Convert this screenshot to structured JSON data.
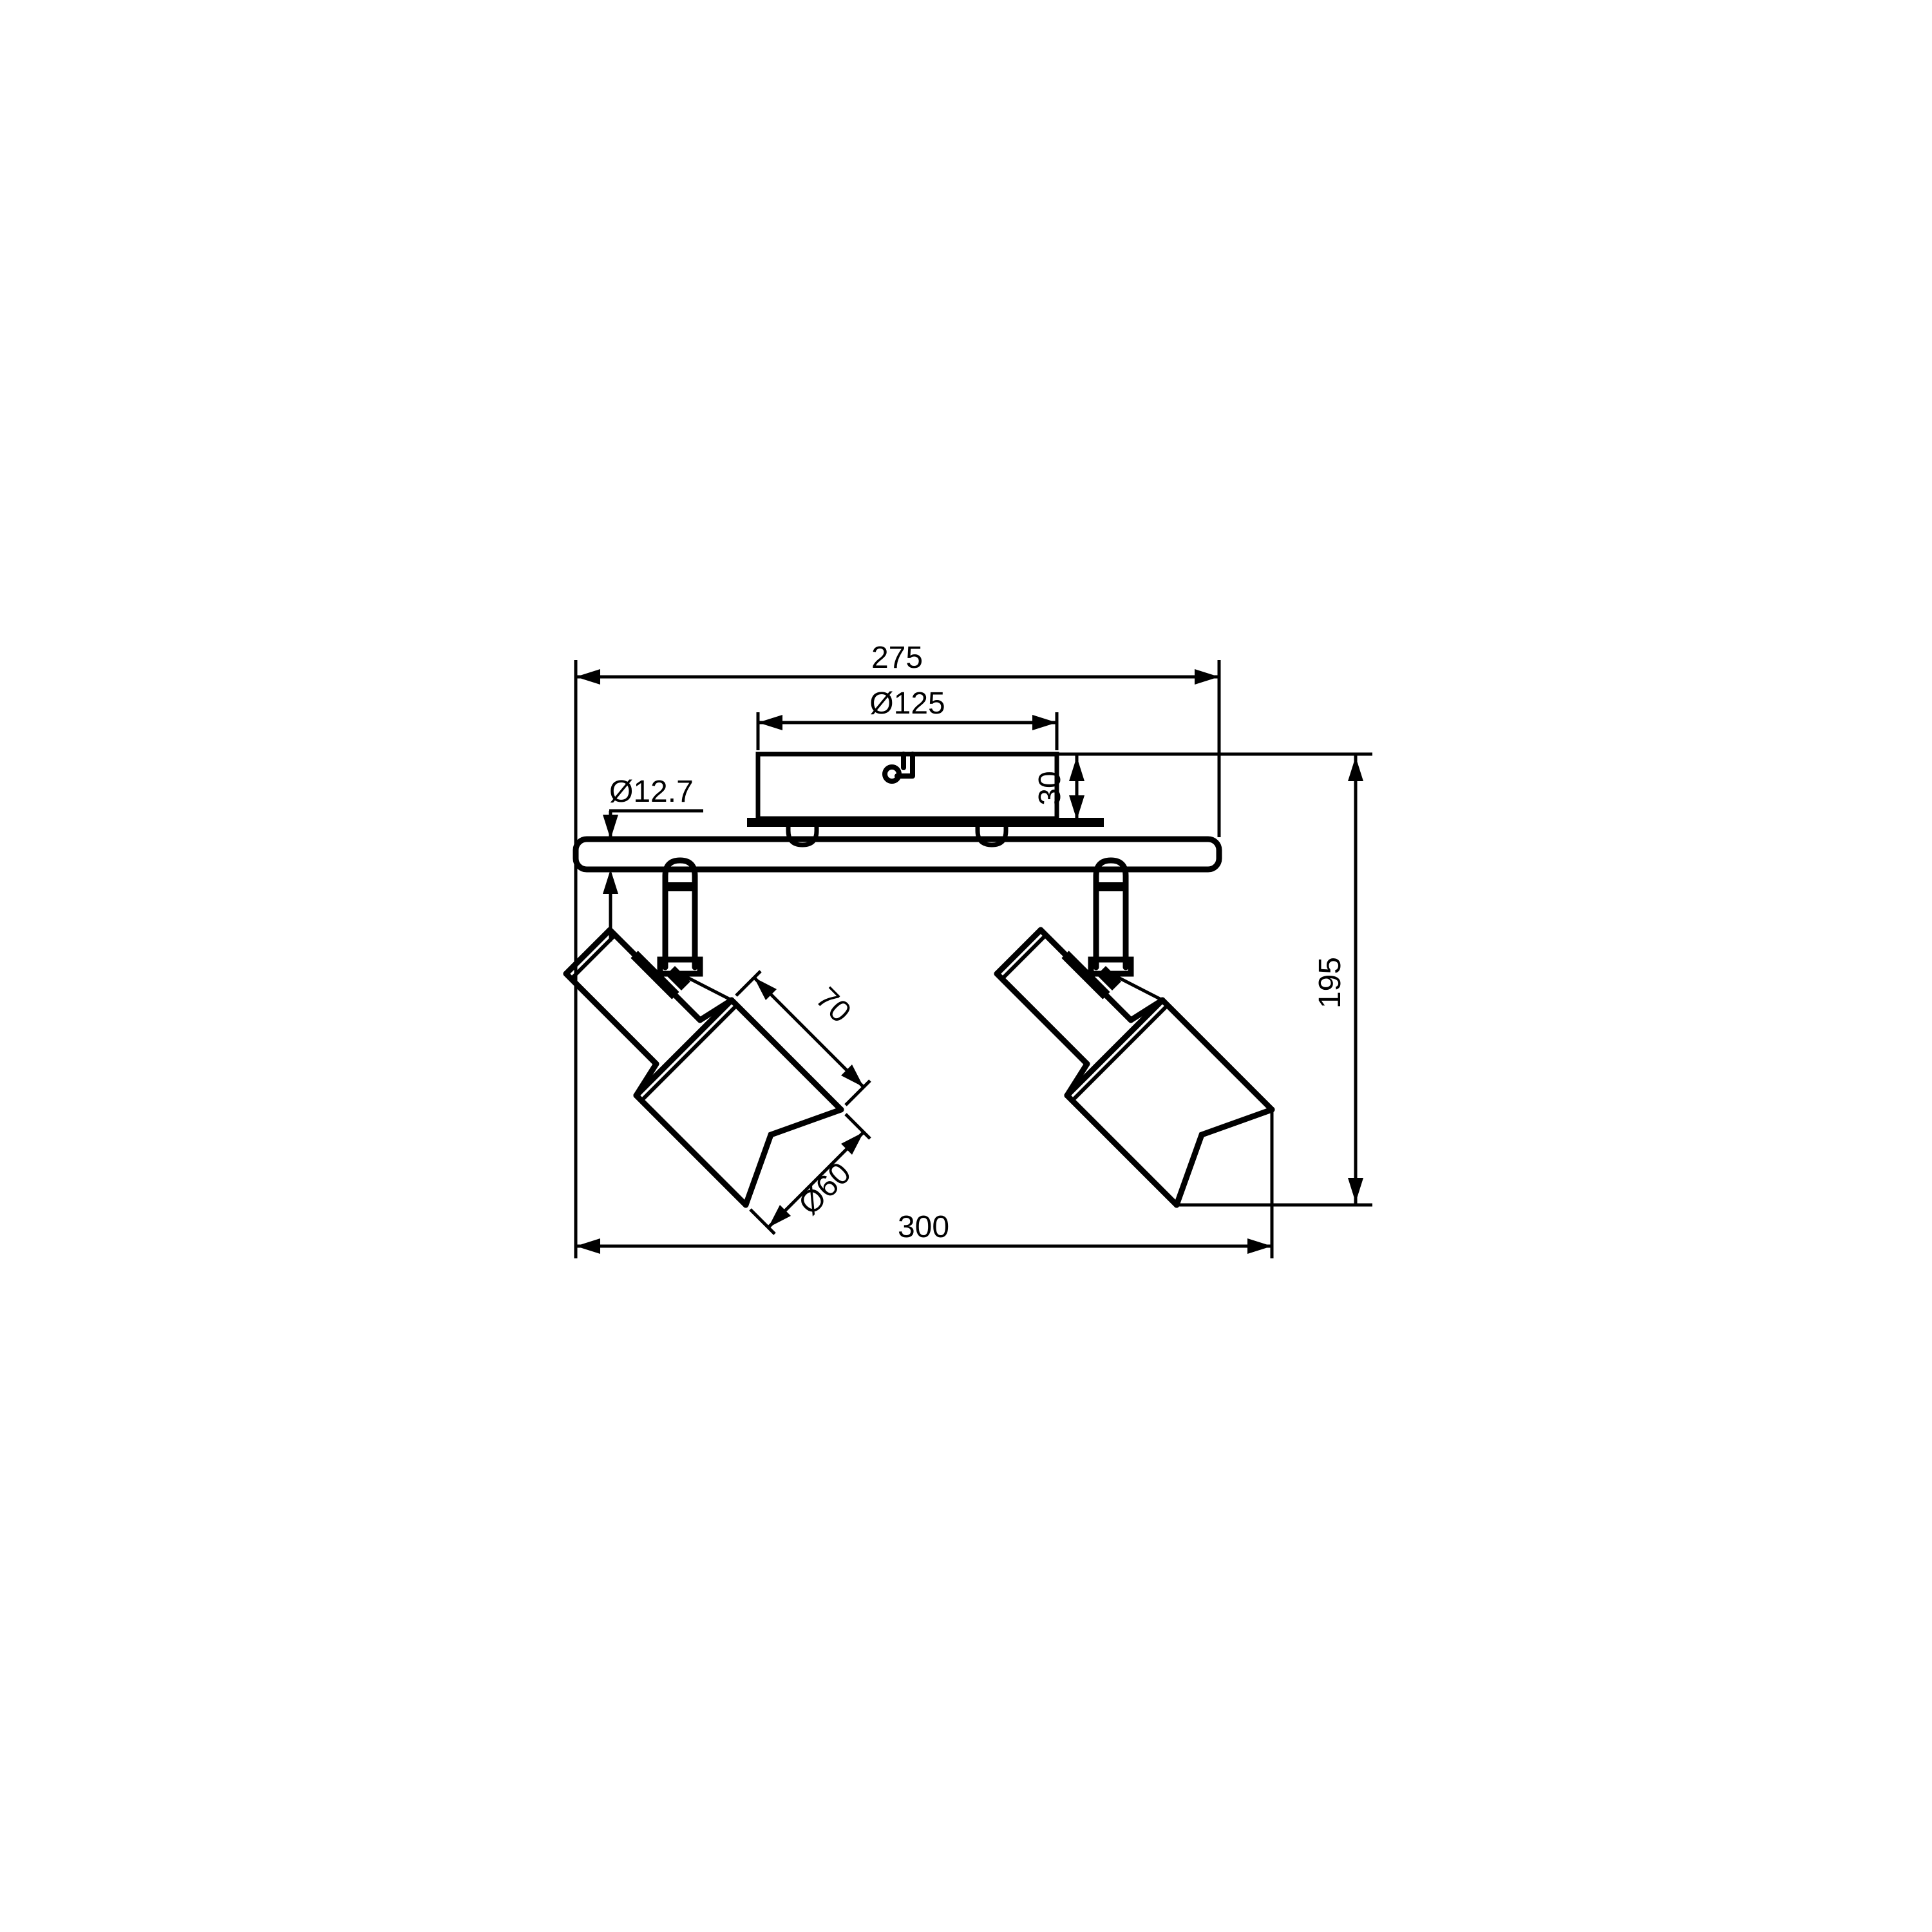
{
  "drawing": {
    "colors": {
      "background": "#ffffff",
      "line": "#000000"
    },
    "icons": {
      "canopy_icon": "cable-grommet-icon"
    },
    "dimensions": {
      "track_length": "275",
      "canopy_diameter": "Ø125",
      "tube_diameter": "Ø12.7",
      "canopy_height": "30",
      "overall_height": "195",
      "head_length": "70",
      "head_diameter": "Ø60",
      "overall_width": "300"
    }
  }
}
